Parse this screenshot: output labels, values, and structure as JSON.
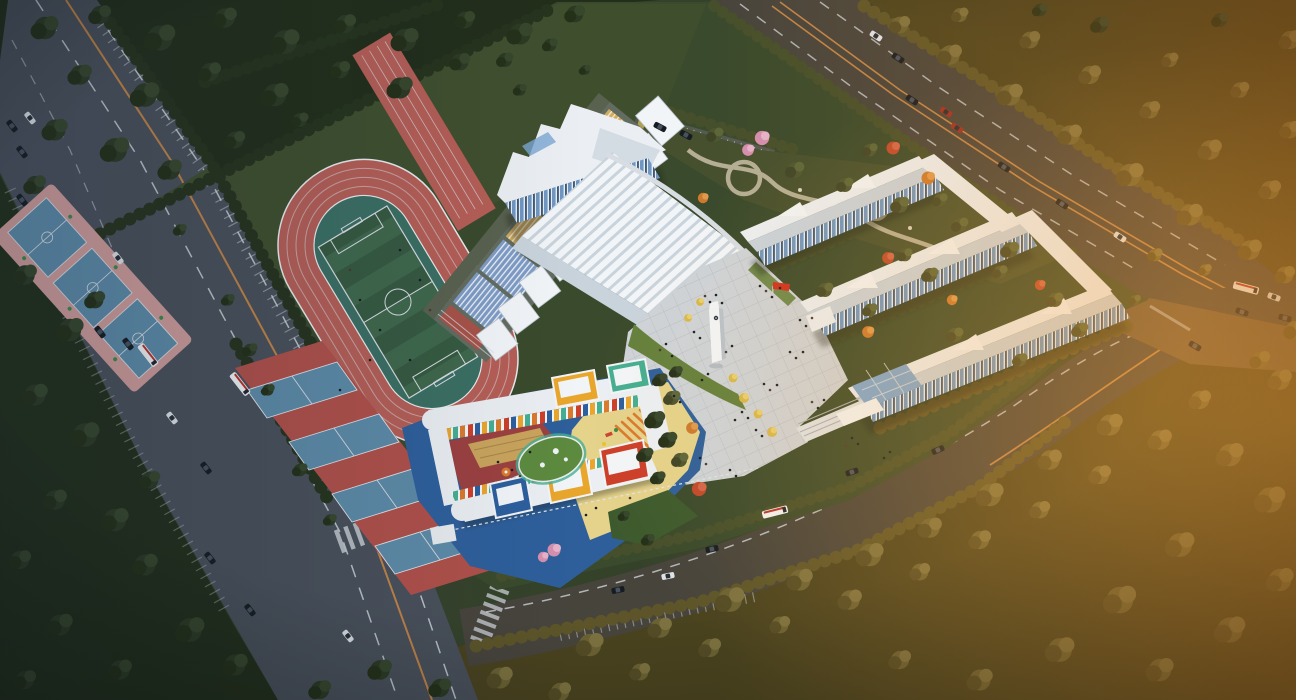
{
  "meta": {
    "type": "architectural-aerial-rendering",
    "subject": "school campus at dusk: running track, gymnasium, teaching buildings, kindergarten, tree-lined roads",
    "canvas": {
      "width": 1296,
      "height": 700
    }
  },
  "palette": {
    "baseGreen": "#35422a",
    "campusGreen": "#3a4a2c",
    "lawnLight": "#41522f",
    "forestDark": "#222e1a",
    "forestWarmBase": "#4a431f",
    "hedge": "#26331d",
    "hedgeOlive": "#464f2b",
    "hedgeWarm": "#5d5529",
    "roadAsphalt": "#49505a",
    "roadAsphaltWarm": "#47443c",
    "roadOrange": "#c08347",
    "lineWhite": "#d7dde2",
    "intersectionPaving": "#6b573b",
    "trackRed": "#b55e56",
    "runoffTeal": "#3b6f63",
    "fieldGreenA": "#3f684c",
    "fieldGreenB": "#365a41",
    "courtBlue": "#5d8ba8",
    "courtPink": "#cf9c9a",
    "courtRed": "#b0504a",
    "standBlue": "#7e9cc6",
    "standTan": "#d2ab61",
    "standRed": "#a85248",
    "standBase": "#636c60",
    "canopyWhite": "#f2f5f8",
    "canopyShadow": "#b9c3cd",
    "bldgWhite": "#ebeff3",
    "bldgShade": "#c9d3dc",
    "glassBlue": "#6f97c1",
    "glassDark": "#3c5a7b",
    "skylight": "#7ba6d2",
    "plaza": "#ced3d8",
    "plazaLine": "#b9bec4",
    "plazaLawn": "#64803d",
    "gardenGreen": "#46502e",
    "gardenPath": "#b5ae95",
    "flagRed": "#d0301e",
    "parkingGray": "#555a50",
    "kgBlue": "#2e5f9b",
    "kgYellowGround": "#e5d28b",
    "kgMaroon": "#9c4040",
    "kgDeck": "#c9a45c",
    "kgGreenRoof": "#5c8a3e",
    "kgBoxYellow": "#e9a62c",
    "kgBoxTeal": "#45ae92",
    "kgBoxBlue": "#2d5f9e",
    "kgBoxRed": "#cc3f2a",
    "kgOrange": "#d97a2e",
    "treeDarkA": "#2c3a24",
    "treeDarkB": "#243018",
    "treeDarkC": "#37472c",
    "treeOliveA": "#4d5531",
    "treeOliveB": "#3e4527",
    "treeOliveC": "#5c6639",
    "treeWarmA": "#6b6233",
    "treeWarmB": "#544c26",
    "treeWarmC": "#7d7240",
    "treePink": "#d58fae",
    "treeRed": "#bf4a2c",
    "treeOrangeC": "#cc7a2e",
    "treeGold": "#d8b84a",
    "carWhite": "#dfe3e8",
    "carDark": "#171c22",
    "carRed": "#9c2e24",
    "busWhite": "#f0f3f5",
    "shadow": "#141c12",
    "personDark": "#1a1e24",
    "personWarm": "#4a3a34"
  },
  "scene": {
    "areas": [
      {
        "name": "running-track",
        "desc": "red 8-lane oval with green soccer pitch and teal runoff"
      },
      {
        "name": "soccer-field",
        "desc": "striped green pitch, white markings, center circle"
      },
      {
        "name": "basketball-courts-north",
        "desc": "3 blue courts on pink apron"
      },
      {
        "name": "courts-south",
        "desc": "4 blue courts on red apron"
      },
      {
        "name": "grandstand",
        "desc": "striped blue/tan seating with white canopies"
      },
      {
        "name": "gymnasium",
        "desc": "white hall, ribbed curved roof, blue glazing"
      },
      {
        "name": "central-plaza",
        "desc": "gridded paving, clock tower, red flag, crowds"
      },
      {
        "name": "teaching-buildings",
        "desc": "three white bars with zigzag roofs and glass stripes"
      },
      {
        "name": "garden",
        "desc": "winding paths, circular nodes, flowering trees"
      },
      {
        "name": "kindergarten",
        "desc": "C-shaped white building, colored box volumes, play yards"
      },
      {
        "name": "roads",
        "desc": "west multilane road, south road, northeast road, intersection"
      },
      {
        "name": "forest",
        "desc": "dark green woods left, sunset-lit trees right"
      }
    ]
  },
  "trees": [
    [
      45,
      28,
      1.6,
      "dark"
    ],
    [
      100,
      15,
      1.3,
      "dark"
    ],
    [
      160,
      38,
      1.8,
      "dark"
    ],
    [
      225,
      18,
      1.4,
      "dark"
    ],
    [
      285,
      42,
      1.7,
      "dark"
    ],
    [
      345,
      24,
      1.3,
      "dark"
    ],
    [
      405,
      40,
      1.6,
      "dark"
    ],
    [
      465,
      20,
      1.2,
      "dark"
    ],
    [
      520,
      34,
      1.5,
      "dark"
    ],
    [
      575,
      14,
      1.2,
      "dark"
    ],
    [
      80,
      75,
      1.4,
      "dark"
    ],
    [
      145,
      95,
      1.7,
      "dark"
    ],
    [
      210,
      72,
      1.3,
      "dark"
    ],
    [
      275,
      95,
      1.6,
      "dark"
    ],
    [
      340,
      70,
      1.2,
      "dark"
    ],
    [
      400,
      88,
      1.5,
      "dark"
    ],
    [
      460,
      62,
      1.2,
      "dark"
    ],
    [
      55,
      130,
      1.5,
      "dark"
    ],
    [
      115,
      150,
      1.7,
      "dark"
    ],
    [
      170,
      170,
      1.4,
      "dark"
    ],
    [
      35,
      185,
      1.3,
      "dark"
    ],
    [
      235,
      140,
      1.2,
      "dark"
    ],
    [
      300,
      120,
      1.0,
      "dark"
    ],
    [
      505,
      60,
      1.0,
      "dark"
    ],
    [
      550,
      45,
      0.9,
      "dark"
    ],
    [
      25,
      275,
      1.4,
      "dark"
    ],
    [
      70,
      330,
      1.6,
      "dark"
    ],
    [
      35,
      395,
      1.5,
      "dark"
    ],
    [
      85,
      435,
      1.7,
      "dark"
    ],
    [
      55,
      500,
      1.4,
      "dark"
    ],
    [
      115,
      520,
      1.6,
      "dark"
    ],
    [
      145,
      565,
      1.5,
      "dark"
    ],
    [
      190,
      630,
      1.7,
      "dark"
    ],
    [
      235,
      665,
      1.5,
      "dark"
    ],
    [
      95,
      300,
      1.2,
      "dark"
    ],
    [
      150,
      480,
      1.2,
      "dark"
    ],
    [
      20,
      560,
      1.3,
      "dark"
    ],
    [
      60,
      625,
      1.5,
      "dark"
    ],
    [
      120,
      670,
      1.4,
      "dark"
    ],
    [
      25,
      680,
      1.3,
      "dark"
    ],
    [
      500,
      678,
      1.5,
      "warm"
    ],
    [
      560,
      692,
      1.3,
      "warm"
    ],
    [
      590,
      645,
      1.6,
      "warm"
    ],
    [
      660,
      628,
      1.4,
      "warm"
    ],
    [
      730,
      600,
      1.7,
      "warm"
    ],
    [
      800,
      580,
      1.5,
      "warm"
    ],
    [
      870,
      555,
      1.6,
      "warm"
    ],
    [
      930,
      528,
      1.4,
      "warm"
    ],
    [
      990,
      495,
      1.6,
      "warm"
    ],
    [
      1050,
      460,
      1.4,
      "warm"
    ],
    [
      1110,
      425,
      1.5,
      "warm"
    ],
    [
      640,
      672,
      1.2,
      "warm"
    ],
    [
      710,
      648,
      1.3,
      "warm"
    ],
    [
      780,
      625,
      1.2,
      "warm"
    ],
    [
      850,
      600,
      1.4,
      "warm"
    ],
    [
      920,
      572,
      1.2,
      "warm"
    ],
    [
      980,
      540,
      1.3,
      "warm"
    ],
    [
      1040,
      510,
      1.2,
      "warm"
    ],
    [
      1100,
      475,
      1.3,
      "warm"
    ],
    [
      1160,
      440,
      1.4,
      "warm"
    ],
    [
      1200,
      400,
      1.3,
      "warm"
    ],
    [
      1230,
      455,
      1.6,
      "warm"
    ],
    [
      1270,
      500,
      1.8,
      "warm"
    ],
    [
      1180,
      545,
      1.7,
      "warm"
    ],
    [
      1120,
      600,
      1.9,
      "warm"
    ],
    [
      1230,
      630,
      1.8,
      "warm"
    ],
    [
      1280,
      580,
      1.6,
      "warm"
    ],
    [
      1060,
      650,
      1.7,
      "warm"
    ],
    [
      980,
      680,
      1.5,
      "warm"
    ],
    [
      900,
      660,
      1.3,
      "warm"
    ],
    [
      1160,
      670,
      1.6,
      "warm"
    ],
    [
      1280,
      380,
      1.4,
      "warm"
    ],
    [
      440,
      688,
      1.3,
      "dark"
    ],
    [
      380,
      670,
      1.4,
      "dark"
    ],
    [
      320,
      690,
      1.3,
      "dark"
    ],
    [
      900,
      25,
      1.2,
      "warm"
    ],
    [
      950,
      55,
      1.4,
      "warm"
    ],
    [
      1010,
      95,
      1.5,
      "warm"
    ],
    [
      1070,
      135,
      1.4,
      "warm"
    ],
    [
      1130,
      175,
      1.6,
      "warm"
    ],
    [
      1190,
      215,
      1.5,
      "warm"
    ],
    [
      1250,
      250,
      1.4,
      "warm"
    ],
    [
      1285,
      275,
      1.2,
      "warm"
    ],
    [
      960,
      15,
      1.0,
      "warm"
    ],
    [
      1030,
      40,
      1.2,
      "warm"
    ],
    [
      1090,
      75,
      1.3,
      "warm"
    ],
    [
      1150,
      110,
      1.2,
      "warm"
    ],
    [
      1210,
      150,
      1.4,
      "warm"
    ],
    [
      1270,
      190,
      1.3,
      "warm"
    ],
    [
      1290,
      130,
      1.2,
      "warm"
    ],
    [
      1240,
      90,
      1.1,
      "warm"
    ],
    [
      1170,
      60,
      1.0,
      "warm"
    ],
    [
      1100,
      25,
      1.1,
      "dark"
    ],
    [
      1040,
      10,
      0.9,
      "dark"
    ],
    [
      1290,
      40,
      1.3,
      "warm"
    ],
    [
      1220,
      20,
      1.0,
      "dark"
    ],
    [
      1295,
      330,
      1.3,
      "warm"
    ],
    [
      1260,
      360,
      1.2,
      "warm"
    ],
    [
      762,
      138,
      1.1,
      "pink"
    ],
    [
      748,
      150,
      0.9,
      "pink"
    ],
    [
      893,
      148,
      1.0,
      "red"
    ],
    [
      928,
      178,
      1.0,
      "orange"
    ],
    [
      703,
      198,
      0.8,
      "orange"
    ],
    [
      715,
      135,
      1.0,
      "olive"
    ],
    [
      795,
      170,
      1.1,
      "olive"
    ],
    [
      845,
      185,
      1.0,
      "olive"
    ],
    [
      900,
      205,
      1.1,
      "olive"
    ],
    [
      960,
      225,
      1.0,
      "olive"
    ],
    [
      1010,
      250,
      1.1,
      "olive"
    ],
    [
      870,
      150,
      0.9,
      "olive"
    ],
    [
      940,
      200,
      0.9,
      "olive"
    ],
    [
      825,
      290,
      1.0,
      "olive"
    ],
    [
      870,
      310,
      0.9,
      "olive"
    ],
    [
      930,
      275,
      1.0,
      "olive"
    ],
    [
      1000,
      272,
      0.9,
      "olive"
    ],
    [
      1055,
      300,
      1.0,
      "olive"
    ],
    [
      905,
      255,
      0.9,
      "olive"
    ],
    [
      955,
      335,
      1.0,
      "olive"
    ],
    [
      1020,
      360,
      0.9,
      "olive"
    ],
    [
      1080,
      330,
      1.0,
      "olive"
    ],
    [
      888,
      258,
      0.9,
      "red"
    ],
    [
      952,
      300,
      0.8,
      "orange"
    ],
    [
      868,
      332,
      0.9,
      "orange"
    ],
    [
      1040,
      285,
      0.8,
      "red"
    ],
    [
      733,
      378,
      0.8,
      "gold"
    ],
    [
      744,
      398,
      0.9,
      "gold"
    ],
    [
      758,
      414,
      0.8,
      "gold"
    ],
    [
      772,
      432,
      0.9,
      "gold"
    ],
    [
      700,
      302,
      0.7,
      "gold"
    ],
    [
      688,
      318,
      0.7,
      "gold"
    ],
    [
      554,
      550,
      1.0,
      "pink"
    ],
    [
      543,
      557,
      0.8,
      "pink"
    ],
    [
      699,
      489,
      1.1,
      "red"
    ],
    [
      692,
      428,
      0.9,
      "orange"
    ],
    [
      672,
      398,
      1.0,
      "olive"
    ],
    [
      660,
      380,
      0.9,
      "dark"
    ],
    [
      676,
      372,
      0.8,
      "dark"
    ],
    [
      648,
      540,
      0.8,
      "dark"
    ],
    [
      624,
      516,
      0.7,
      "dark"
    ],
    [
      655,
      420,
      1.2,
      "dark"
    ],
    [
      668,
      440,
      1.1,
      "dark"
    ],
    [
      645,
      455,
      1.0,
      "dark"
    ],
    [
      680,
      460,
      1.0,
      "olive"
    ],
    [
      658,
      478,
      0.9,
      "dark"
    ],
    [
      250,
      350,
      0.9,
      "dark"
    ],
    [
      268,
      390,
      0.8,
      "dark"
    ],
    [
      300,
      470,
      0.9,
      "dark"
    ],
    [
      330,
      520,
      0.8,
      "dark"
    ],
    [
      228,
      300,
      0.8,
      "dark"
    ],
    [
      180,
      230,
      0.8,
      "dark"
    ],
    [
      520,
      90,
      0.8,
      "dark"
    ],
    [
      585,
      70,
      0.7,
      "dark"
    ],
    [
      1155,
      255,
      0.9,
      "warm"
    ],
    [
      1205,
      270,
      0.8,
      "warm"
    ],
    [
      1135,
      300,
      0.7,
      "olive"
    ]
  ],
  "vehicles": [
    [
      30,
      118,
      52,
      "white"
    ],
    [
      22,
      200,
      52,
      "dark"
    ],
    [
      118,
      258,
      52,
      "white"
    ],
    [
      100,
      332,
      52,
      "dark"
    ],
    [
      128,
      344,
      52,
      "dark"
    ],
    [
      172,
      418,
      52,
      "white"
    ],
    [
      206,
      468,
      52,
      "dark"
    ],
    [
      210,
      558,
      52,
      "dark"
    ],
    [
      250,
      610,
      52,
      "dark"
    ],
    [
      348,
      636,
      52,
      "white"
    ],
    [
      148,
      355,
      52,
      "bus"
    ],
    [
      240,
      384,
      52,
      "bus"
    ],
    [
      12,
      126,
      52,
      "dark"
    ],
    [
      22,
      152,
      52,
      "dark"
    ],
    [
      668,
      576,
      -12,
      "white"
    ],
    [
      712,
      549,
      -12,
      "dark"
    ],
    [
      852,
      472,
      -18,
      "dark"
    ],
    [
      938,
      450,
      -24,
      "dark"
    ],
    [
      775,
      512,
      -14,
      "bus"
    ],
    [
      618,
      590,
      -12,
      "dark"
    ],
    [
      898,
      58,
      33,
      "dark"
    ],
    [
      912,
      100,
      33,
      "dark"
    ],
    [
      946,
      112,
      33,
      "red"
    ],
    [
      957,
      128,
      33,
      "red"
    ],
    [
      1004,
      167,
      33,
      "dark"
    ],
    [
      1062,
      204,
      33,
      "dark"
    ],
    [
      1120,
      237,
      33,
      "white"
    ],
    [
      876,
      36,
      33,
      "white"
    ],
    [
      1246,
      288,
      15,
      "bus"
    ],
    [
      1274,
      297,
      20,
      "white"
    ],
    [
      1242,
      312,
      20,
      "dark"
    ],
    [
      1285,
      318,
      15,
      "dark"
    ],
    [
      1195,
      346,
      30,
      "dark"
    ],
    [
      660,
      127,
      28,
      "dark"
    ],
    [
      686,
      135,
      28,
      "dark"
    ]
  ],
  "people": [
    [
      705,
      296
    ],
    [
      710,
      302
    ],
    [
      716,
      295
    ],
    [
      722,
      303
    ],
    [
      760,
      286
    ],
    [
      766,
      291
    ],
    [
      772,
      297
    ],
    [
      780,
      288
    ],
    [
      800,
      320
    ],
    [
      806,
      326
    ],
    [
      812,
      318
    ],
    [
      790,
      352
    ],
    [
      796,
      358
    ],
    [
      803,
      352
    ],
    [
      764,
      384
    ],
    [
      770,
      390
    ],
    [
      777,
      385
    ],
    [
      742,
      412
    ],
    [
      748,
      418
    ],
    [
      735,
      420
    ],
    [
      812,
      402
    ],
    [
      818,
      408
    ],
    [
      824,
      400
    ],
    [
      852,
      438
    ],
    [
      858,
      444
    ],
    [
      846,
      446
    ],
    [
      884,
      458
    ],
    [
      890,
      452
    ],
    [
      700,
      338
    ],
    [
      694,
      332
    ],
    [
      726,
      352
    ],
    [
      732,
      346
    ],
    [
      756,
      430
    ],
    [
      762,
      436
    ],
    [
      700,
      458
    ],
    [
      706,
      464
    ],
    [
      680,
      402
    ],
    [
      674,
      396
    ],
    [
      730,
      470
    ],
    [
      736,
      476
    ],
    [
      660,
      350
    ],
    [
      666,
      344
    ],
    [
      672,
      356
    ],
    [
      702,
      380
    ],
    [
      708,
      374
    ],
    [
      350,
      270
    ],
    [
      360,
      300
    ],
    [
      380,
      330
    ],
    [
      400,
      250
    ],
    [
      420,
      280
    ],
    [
      430,
      310
    ],
    [
      370,
      360
    ],
    [
      410,
      360
    ],
    [
      340,
      390
    ],
    [
      512,
      470
    ],
    [
      520,
      476
    ],
    [
      530,
      452
    ],
    [
      498,
      462
    ],
    [
      586,
      515
    ],
    [
      596,
      508
    ],
    [
      630,
      498
    ]
  ]
}
